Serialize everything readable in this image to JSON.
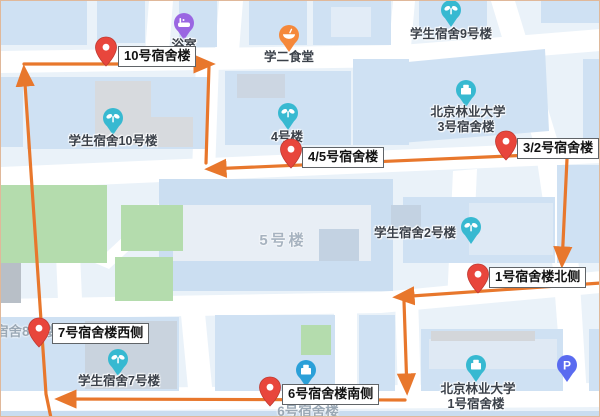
{
  "map": {
    "background_color": "#eaf2f9",
    "road_color": "#ffffff",
    "building_color": "#cfe1f3",
    "green_color": "#b4dcad",
    "route_color": "#e8772c",
    "marker_color": "#e8463c"
  },
  "markers": [
    {
      "label": "10号宿舍楼"
    },
    {
      "label": "4/5号宿舍楼"
    },
    {
      "label": "3/2号宿舍楼"
    },
    {
      "label": "1号宿舍楼北侧"
    },
    {
      "label": "7号宿舍楼西侧"
    },
    {
      "label": "6号宿舍楼南侧"
    }
  ],
  "pois": [
    {
      "label": "浴室",
      "color": "#9a66e2",
      "icon": "bath"
    },
    {
      "label": "学二食堂",
      "color": "#f5883a",
      "icon": "food"
    },
    {
      "label": "学生宿舍9号楼",
      "color": "#37b9d1",
      "icon": "sprout"
    },
    {
      "label_line1": "北京林业大学",
      "label_line2": "3号宿舍楼",
      "color": "#37b9d1",
      "icon": "building"
    },
    {
      "label": "4号楼",
      "color": "#37b9d1",
      "icon": "sprout"
    },
    {
      "label": "学生宿舍10号楼",
      "color": "#37b9d1",
      "icon": "sprout"
    },
    {
      "label": "学生宿舍2号楼",
      "color": "#37b9d1",
      "icon": "sprout"
    },
    {
      "label": "学生宿舍7号楼",
      "color": "#37b9d1",
      "icon": "sprout"
    },
    {
      "label": "",
      "color": "#2ba0d8",
      "icon": "building"
    },
    {
      "label_line1": "北京林业大学",
      "label_line2": "1号宿舍楼",
      "color": "#37b9d1",
      "icon": "building"
    },
    {
      "glyph_letter": "P",
      "color": "#5a6bf0",
      "icon": "parking"
    }
  ],
  "map_texts": [
    {
      "label": "5号楼"
    },
    {
      "label": "宿舍8号楼"
    },
    {
      "label": "6号宿舍楼"
    }
  ],
  "route": {
    "segments": [
      {
        "points": "50,417 45,393 23,68"
      },
      {
        "points": "23,63 210,63"
      },
      {
        "points": "208,65 205,162"
      },
      {
        "points": "600,151 208,168"
      },
      {
        "points": "566,158 561,263"
      },
      {
        "points": "600,282 396,296"
      },
      {
        "points": "403,300 406,390"
      },
      {
        "points": "404,399 58,398"
      }
    ]
  }
}
